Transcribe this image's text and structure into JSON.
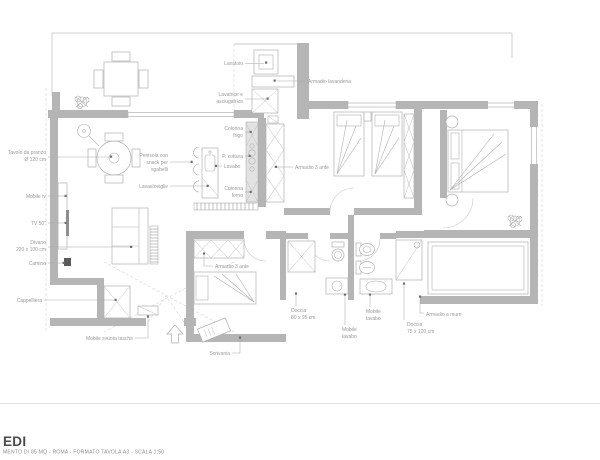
{
  "title_block": {
    "title": "EDI",
    "subtitle": "MENTO DI 85 MQ - ROMA - FORMATO TAVOLA A3 - SCALA 1:50"
  },
  "colors": {
    "wall_gray": "#b5b5b5",
    "label_gray": "#9a9a9a",
    "title_dark": "#4a4a4a",
    "fireplace_dark": "#5a5a5a"
  },
  "plan": {
    "labels": {
      "lavatoio": {
        "lines": [
          "Lavatoio"
        ]
      },
      "armadio_lavanderia": {
        "lines": [
          "Armadio lavanderia"
        ]
      },
      "lavatrice": {
        "lines": [
          "Lavatrice e",
          "asciugatrice"
        ]
      },
      "tavolo": {
        "lines": [
          "Tavolo da pranzo",
          "Ø 120 cm"
        ]
      },
      "mobile_tv": {
        "lines": [
          "Mobile tv"
        ]
      },
      "tv50": {
        "lines": [
          "TV 50\""
        ]
      },
      "divano": {
        "lines": [
          "Divano",
          "220 x 100 cm"
        ]
      },
      "camino": {
        "lines": [
          "Camino"
        ]
      },
      "cappelliera": {
        "lines": [
          "Cappelliera"
        ]
      },
      "mobile_svuota": {
        "lines": [
          "Mobile svuota tasche"
        ]
      },
      "colonna_frigo": {
        "lines": [
          "Colonna",
          "frigo"
        ]
      },
      "p_cottura": {
        "lines": [
          "P. cottura"
        ]
      },
      "lavabo": {
        "lines": [
          "Lavabo"
        ]
      },
      "colonna_forno": {
        "lines": [
          "Colonna",
          "forno"
        ]
      },
      "penisola": {
        "lines": [
          "Penisola con",
          "snack per",
          "sgabelli"
        ]
      },
      "lavastoviglie": {
        "lines": [
          "Lavastoviglie"
        ]
      },
      "armadio3_corridoio": {
        "lines": [
          "Armadio 3 ante"
        ]
      },
      "armadio3_camera": {
        "lines": [
          "Armadio 3 ante"
        ]
      },
      "doccia1": {
        "lines": [
          "Doccia",
          "80 x 95 cm"
        ]
      },
      "mobile_lavabo_1": {
        "lines": [
          "Mobile",
          "lavabo"
        ]
      },
      "mobile_lavabo_2": {
        "lines": [
          "Mobile",
          "lavabo"
        ]
      },
      "doccia2": {
        "lines": [
          "Doccia",
          "75 x 120 cm"
        ]
      },
      "armadio_muro": {
        "lines": [
          "Armadio a muro"
        ]
      },
      "scrivania": {
        "lines": [
          "Scrivania"
        ]
      }
    }
  }
}
